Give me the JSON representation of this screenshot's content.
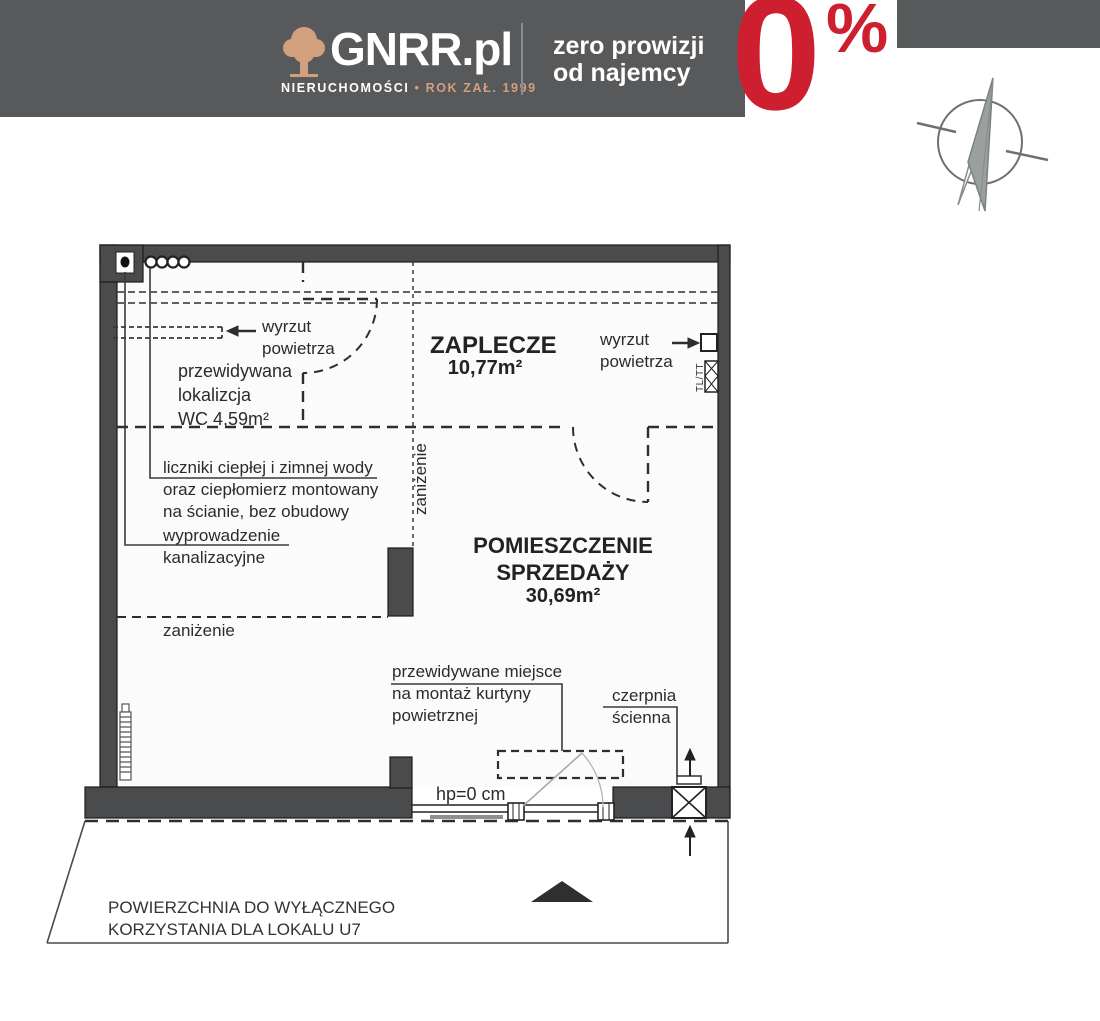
{
  "header": {
    "brand": "GNRR.pl",
    "tagline_left": "NIERUCHOMOŚCI",
    "tagline_sep": "•",
    "tagline_right": "ROK ZAŁ. 1999",
    "promo_line1": "zero prowizji",
    "promo_line2": "od najemcy",
    "zero_value": "0",
    "zero_percent": "%",
    "colors": {
      "bar_gray": "#58595b",
      "accent_red": "#cd1f2f",
      "logo_tan": "#d2a07e"
    }
  },
  "plan": {
    "zaplecze": {
      "name": "ZAPLECZE",
      "area": "10,77m²"
    },
    "sales": {
      "name_line1": "POMIESZCZENIE",
      "name_line2": "SPRZEDAŻY",
      "area": "30,69m²"
    },
    "wc": {
      "line1": "przewidywana",
      "line2": "lokalizcja",
      "line3": "WC 4,59m²"
    },
    "wyrzut_left": {
      "line1": "wyrzut",
      "line2": "powietrza"
    },
    "wyrzut_right": {
      "line1": "wyrzut",
      "line2": "powietrza"
    },
    "liczniki": {
      "line1": "liczniki ciepłej i zimnej wody",
      "line2": "oraz ciepłomierz montowany",
      "line3": "na ścianie, bez obudowy"
    },
    "wyprowadzenie": {
      "line1": "wyprowadzenie",
      "line2": "kanalizacyjne"
    },
    "zanizenie_vertical": "zaniżenie",
    "zanizenie_horizontal": "zaniżenie",
    "kurtyna": {
      "line1": "przewidywane miejsce",
      "line2": "na montaż kurtyny",
      "line3": "powietrznej"
    },
    "czerpnia": {
      "line1": "czerpnia",
      "line2": "ścienna"
    },
    "hp_label": "hp=0 cm",
    "shaft_label": "TL/TT"
  },
  "footer": {
    "line1": "POWIERZCHNIA DO WYŁĄCZNEGO",
    "line2": "KORZYSTANIA DLA LOKALU U7"
  }
}
